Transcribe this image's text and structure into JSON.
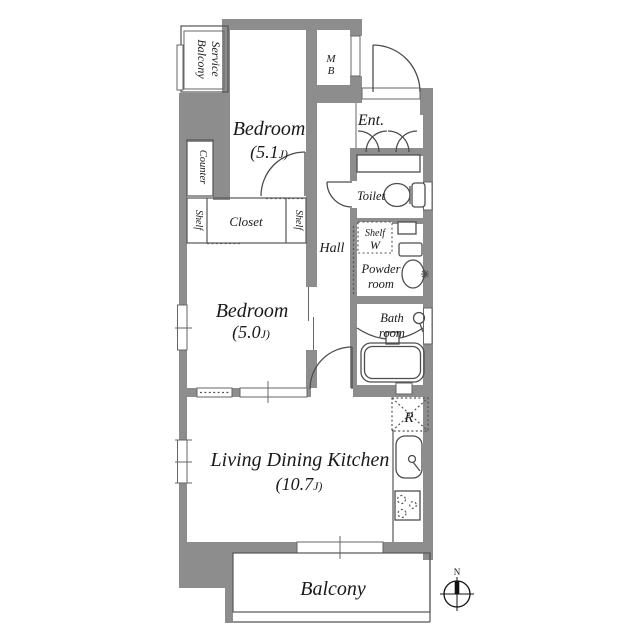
{
  "floorplan": {
    "rooms": {
      "service_balcony": {
        "line1": "Service",
        "line2": "Balcony"
      },
      "bedroom1": {
        "name": "Bedroom",
        "size_num": "(5.1",
        "size_unit": "J)"
      },
      "bedroom2": {
        "name": "Bedroom",
        "size_num": "(5.0",
        "size_unit": "J)"
      },
      "ldk": {
        "name": "Living Dining Kitchen",
        "size_num": "(10.7",
        "size_unit": "J)"
      },
      "mb": {
        "line1": "M",
        "line2": "B"
      },
      "entrance": {
        "label": "Ent."
      },
      "toilet": {
        "label": "Toilet"
      },
      "hall": {
        "label": "Hall"
      },
      "shelf_w": {
        "line1": "Shelf",
        "line2": "W"
      },
      "powder_room": {
        "line1": "Powder",
        "line2": "room"
      },
      "bath_room": {
        "line1": "Bath",
        "line2": "room"
      },
      "counter": {
        "label": "Counter"
      },
      "closet": {
        "label": "Closet"
      },
      "shelf_left": {
        "label": "Shelf"
      },
      "shelf_right": {
        "label": "Shelf"
      },
      "refrigerator": {
        "label": "R"
      },
      "balcony": {
        "label": "Balcony"
      }
    },
    "compass": {
      "north": "N"
    },
    "colors": {
      "wall": "#8d8d8d",
      "line": "#4d4d4d",
      "text": "#1a1a1a",
      "background": "#ffffff"
    }
  }
}
